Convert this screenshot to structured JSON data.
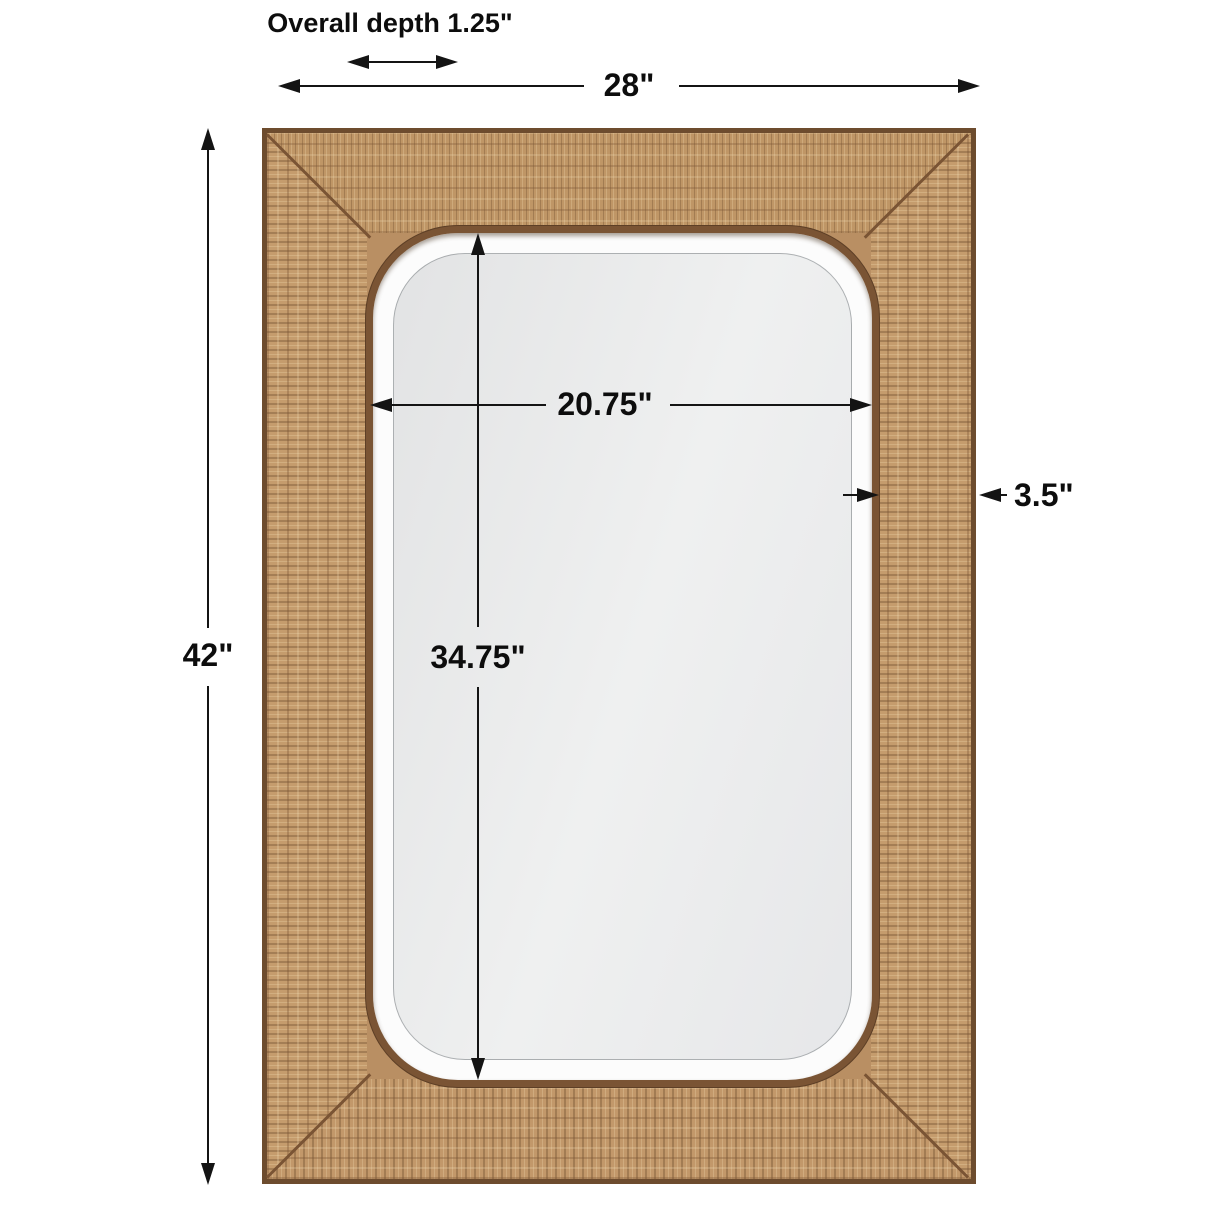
{
  "diagram": {
    "type": "product-dimension-diagram",
    "product": "Rectangular wall mirror with woven rattan frame and beveled glass",
    "annotations": {
      "overall_depth": {
        "label": "Overall depth 1.25\""
      },
      "overall_width": {
        "label": "28\""
      },
      "overall_height": {
        "label": "42\""
      },
      "mirror_width": {
        "label": "20.75\""
      },
      "mirror_height": {
        "label": "34.75\""
      },
      "frame_thickness": {
        "label": "3.5\""
      }
    },
    "colors": {
      "dimension_line": "#141414",
      "rattan_base": "#c2986a",
      "wood_trim": "#7a5434",
      "frame_outer_border": "#6d4c2e",
      "bevel": "#fcfcfc",
      "mirror_face": "#ebecec",
      "background": "#ffffff"
    }
  }
}
